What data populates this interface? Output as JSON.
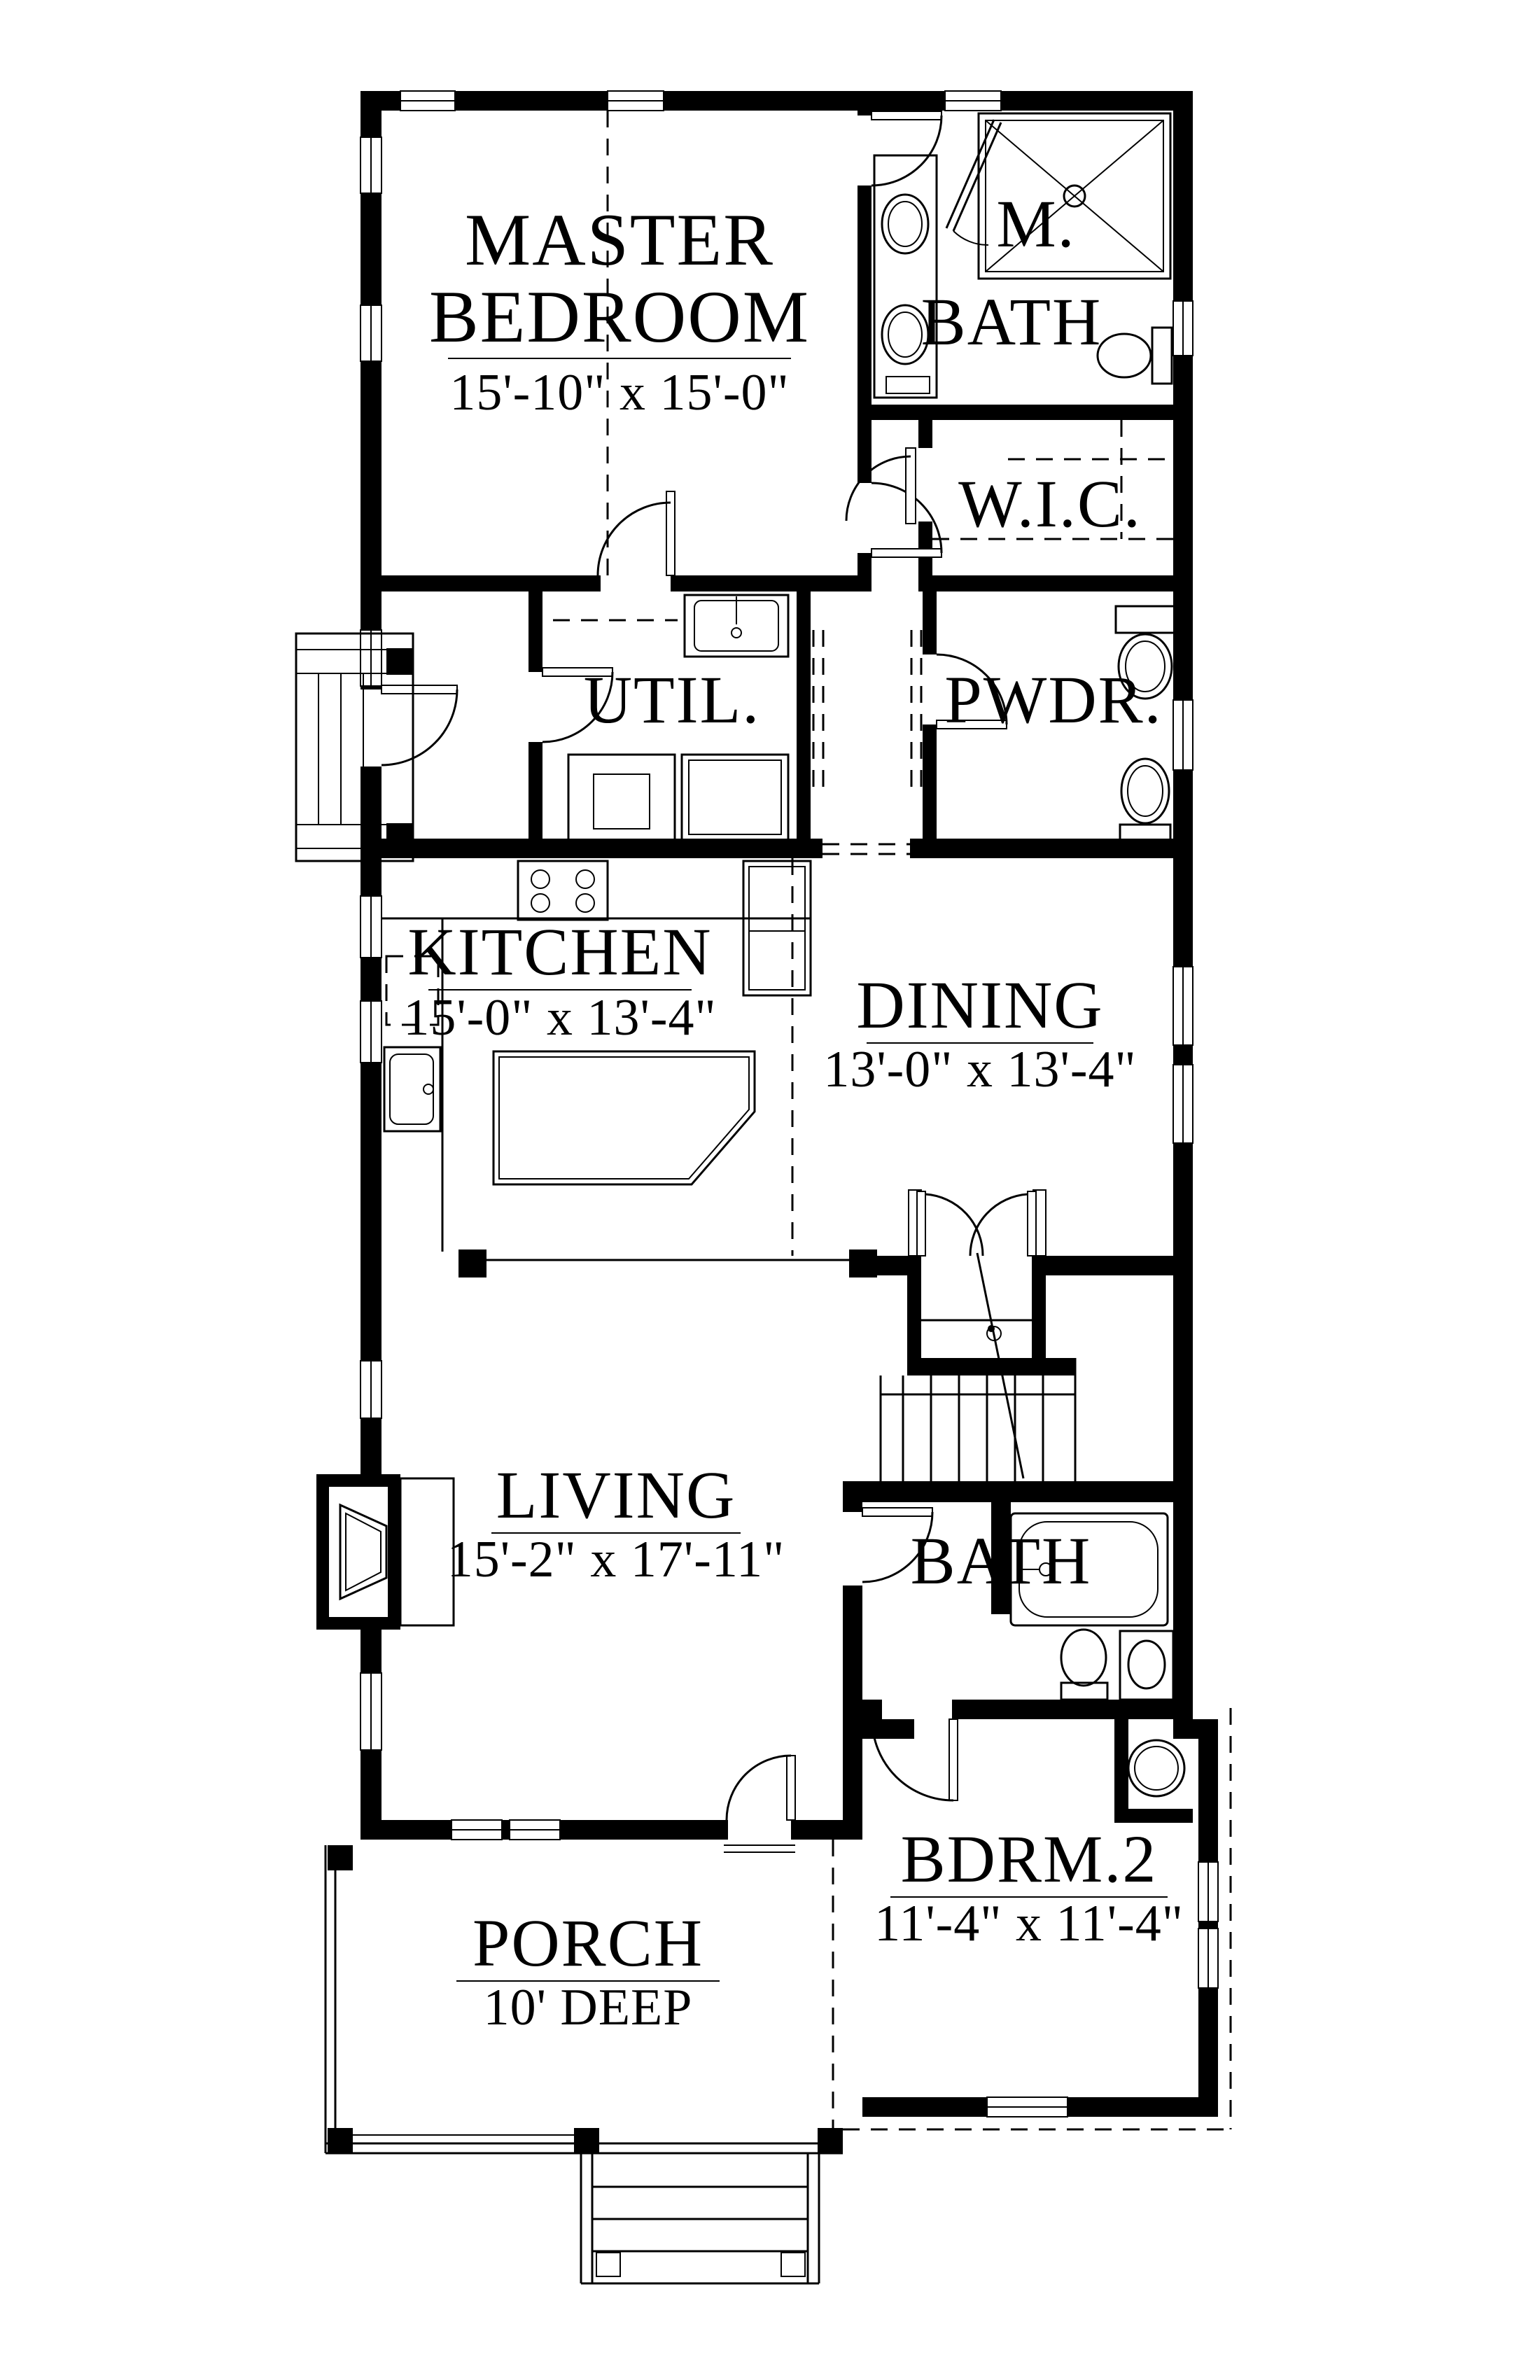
{
  "drawing": {
    "type": "first-floor-plan",
    "ink_color": "#000000",
    "paper_color": "#ffffff"
  },
  "rooms": {
    "master_bedroom": {
      "line1": "MASTER",
      "line2": "BEDROOM",
      "dims": "15'-10\" x 15'-0\""
    },
    "m_bath": {
      "line1": "M.",
      "line2": "BATH"
    },
    "wic": {
      "label": "W.I.C."
    },
    "util": {
      "label": "UTIL."
    },
    "pwdr": {
      "label": "PWDR."
    },
    "kitchen": {
      "label": "KITCHEN",
      "dims": "15'-0\" x 13'-4\""
    },
    "dining": {
      "label": "DINING",
      "dims": "13'-0\" x 13'-4\""
    },
    "living": {
      "label": "LIVING",
      "dims": "15'-2\" x 17'-11\""
    },
    "bath": {
      "label": "BATH"
    },
    "bdrm2": {
      "label": "BDRM.2",
      "dims": "11'-4\" x 11'-4\""
    },
    "porch": {
      "label": "PORCH",
      "dims": "10' DEEP"
    }
  }
}
